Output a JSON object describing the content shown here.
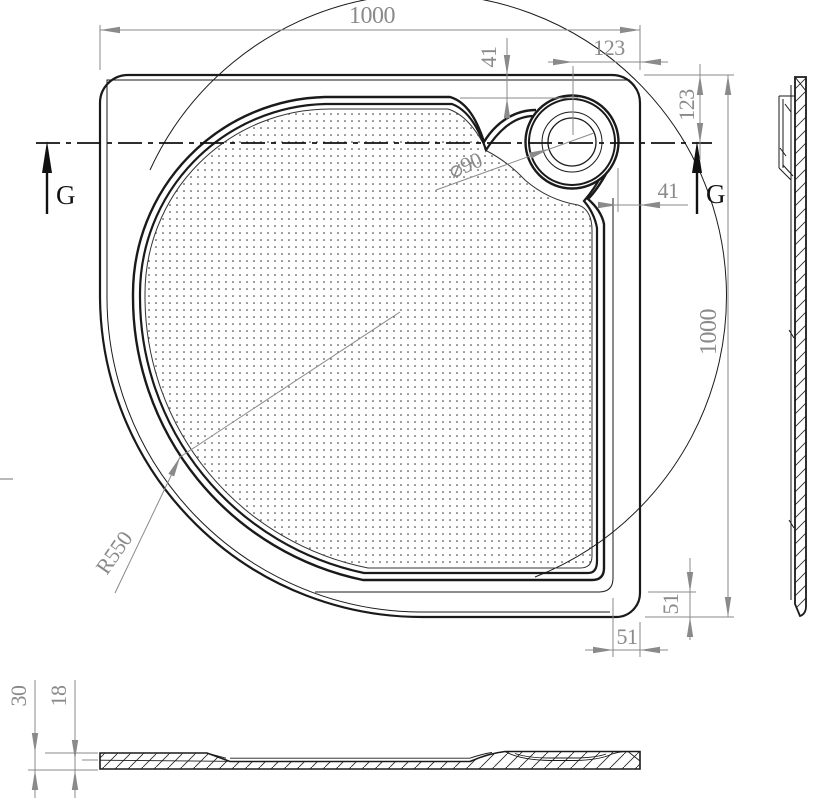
{
  "dims": {
    "overall_width": "1000",
    "overall_height": "1000",
    "rim_offset_from_top": "41",
    "drain_center_from_right": "123",
    "drain_center_from_top": "123",
    "drain_rim_from_right": "41",
    "flange_right": "51",
    "flange_bottom": "51",
    "front_radius": "R550",
    "drain_diameter": "⌀90",
    "edge_height": "30",
    "wall_thickness": "18"
  },
  "section_marker": "G",
  "colors": {
    "line": "#1a1a1a",
    "dimension": "#8a8a8a",
    "background": "#ffffff"
  }
}
